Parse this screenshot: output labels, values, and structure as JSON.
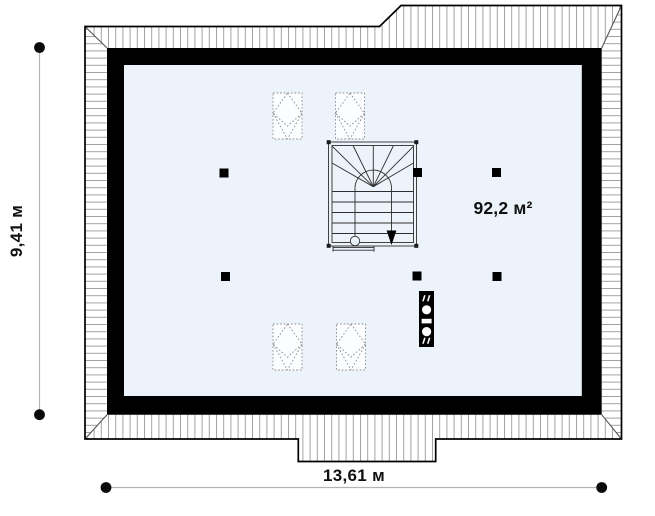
{
  "labels": {
    "height_dimension": "9,41 м",
    "width_dimension": "13,61 м",
    "area": "92,2 м²"
  },
  "colors": {
    "floor_fill": "#edf3fa",
    "wall": "#000000",
    "hatch_line": "#9a9a9a",
    "dimension_line": "#b4b4b4",
    "text": "#101010"
  },
  "features": {
    "structural_posts": [
      [
        224,
        173
      ],
      [
        417.5,
        172.5
      ],
      [
        496.5,
        172.5
      ],
      [
        225.5,
        276.5
      ],
      [
        417,
        276
      ],
      [
        497,
        276.5
      ]
    ],
    "post_size": 9,
    "roof_windows": [
      [
        273,
        93
      ],
      [
        335.5,
        93
      ],
      [
        273,
        324
      ],
      [
        336.5,
        324
      ]
    ],
    "roof_window_size": [
      29,
      46
    ],
    "staircase": {
      "type": "u-shaped-winder-stair",
      "x": 328.5,
      "y": 142,
      "width": 88,
      "height": 104
    },
    "chimney": {
      "x": 419,
      "y": 291,
      "width": 15,
      "height": 56
    }
  }
}
